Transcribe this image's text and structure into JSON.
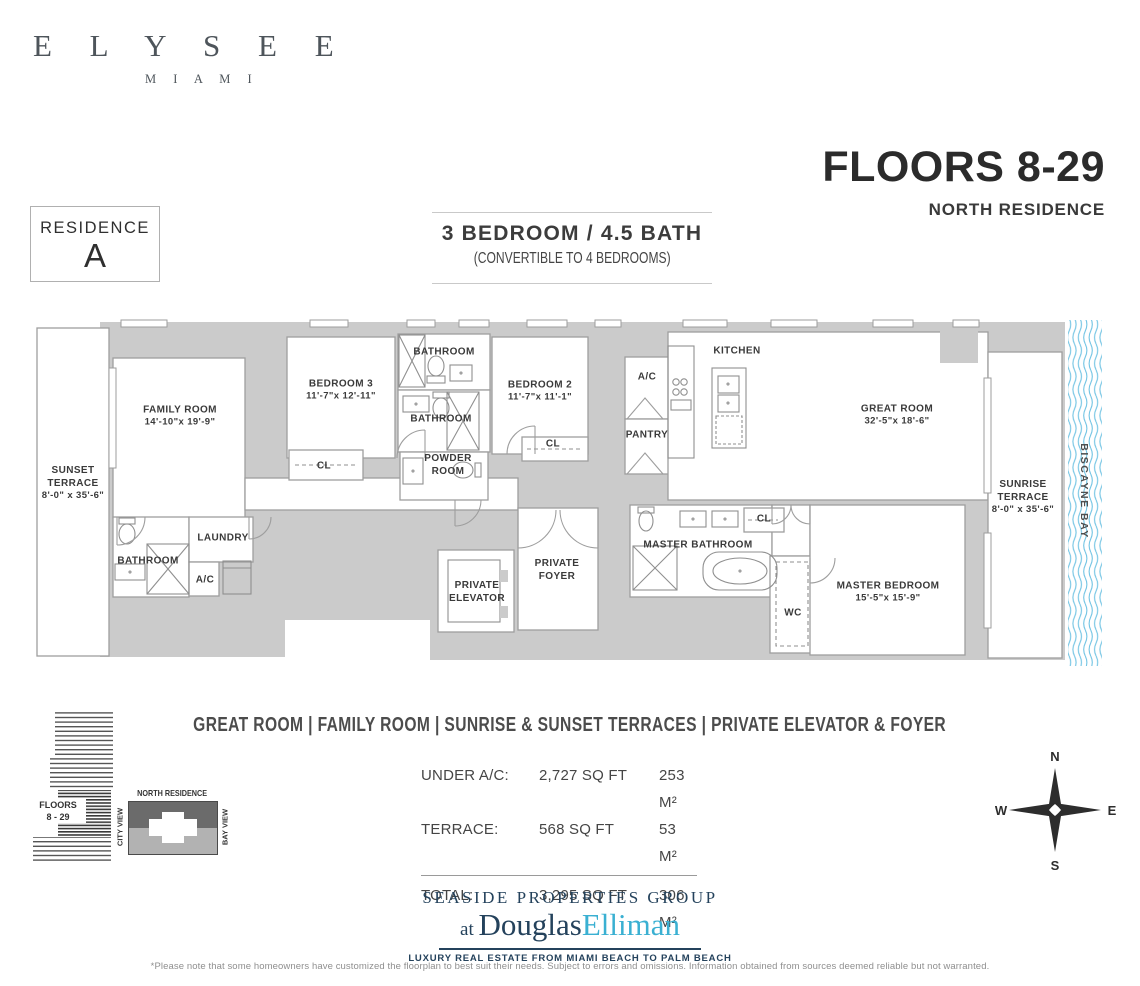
{
  "brand": {
    "name": "E L Y S E E",
    "city": "M I A M I"
  },
  "header": {
    "floors_title": "FLOORS 8-29",
    "floors_subtitle": "NORTH RESIDENCE",
    "residence_label": "RESIDENCE",
    "residence_letter": "A",
    "bed_bath": "3 BEDROOM  /  4.5 BATH",
    "convertible": "(CONVERTIBLE TO 4 BEDROOMS)"
  },
  "plan": {
    "water_label": "BISCAYNE BAY",
    "water_color": "#70c3e3",
    "wall_color": "#cbcbcb",
    "rooms": [
      {
        "name": "SUNSET TERRACE",
        "dims": "8'-0\" x 35'-6\""
      },
      {
        "name": "FAMILY ROOM",
        "dims": "14'-10\"x 19'-9\""
      },
      {
        "name": "BEDROOM 3",
        "dims": "11'-7\"x 12'-11\""
      },
      {
        "name": "BATHROOM"
      },
      {
        "name": "BATHROOM"
      },
      {
        "name": "POWDER ROOM"
      },
      {
        "name": "BEDROOM 2",
        "dims": "11'-7\"x 11'-1\""
      },
      {
        "name": "A/C"
      },
      {
        "name": "PANTRY"
      },
      {
        "name": "KITCHEN"
      },
      {
        "name": "GREAT ROOM",
        "dims": "32'-5\"x 18'-6\""
      },
      {
        "name": "SUNRISE TERRACE",
        "dims": "8'-0\" x 35'-6\""
      },
      {
        "name": "BATHROOM"
      },
      {
        "name": "LAUNDRY"
      },
      {
        "name": "A/C"
      },
      {
        "name": "PRIVATE ELEVATOR"
      },
      {
        "name": "PRIVATE FOYER"
      },
      {
        "name": "MASTER BATHROOM"
      },
      {
        "name": "CL"
      },
      {
        "name": "WC"
      },
      {
        "name": "MASTER BEDROOM",
        "dims": "15'-5\"x 15'-9\""
      },
      {
        "name": "CL"
      },
      {
        "name": "CL"
      }
    ]
  },
  "features_line": "GREAT ROOM   |   FAMILY ROOM   |   SUNRISE & SUNSET TERRACES   |   PRIVATE ELEVATOR & FOYER",
  "areas": {
    "rows": [
      {
        "label": "UNDER A/C:",
        "sqft": "2,727 SQ FT",
        "m2": "253 M²"
      },
      {
        "label": "TERRACE:",
        "sqft": "568 SQ FT",
        "m2": "53 M²"
      },
      {
        "label": "TOTAL:",
        "sqft": "3,295 SQ FT",
        "m2": "306 M²"
      }
    ]
  },
  "building_key": {
    "floors_line1": "FLOORS",
    "floors_line2": "8 - 29",
    "residence": "NORTH RESIDENCE",
    "left_view": "CITY VIEW",
    "right_view": "BAY VIEW"
  },
  "compass": {
    "n": "N",
    "e": "E",
    "s": "S",
    "w": "W"
  },
  "broker": {
    "group": "SEASIDE PROPERTIES GROUP",
    "at": "at ",
    "name1": "Douglas",
    "name2": "Elliman",
    "tagline": "LUXURY REAL ESTATE FROM MIAMI BEACH TO PALM BEACH",
    "navy": "#24425c",
    "blue": "#3ab0d2"
  },
  "footer": {
    "disclaimer": "*Please note that some homeowners have customized the floorplan to best suit their needs. Subject to errors and omissions. Information obtained from sources deemed reliable but not warranted."
  }
}
